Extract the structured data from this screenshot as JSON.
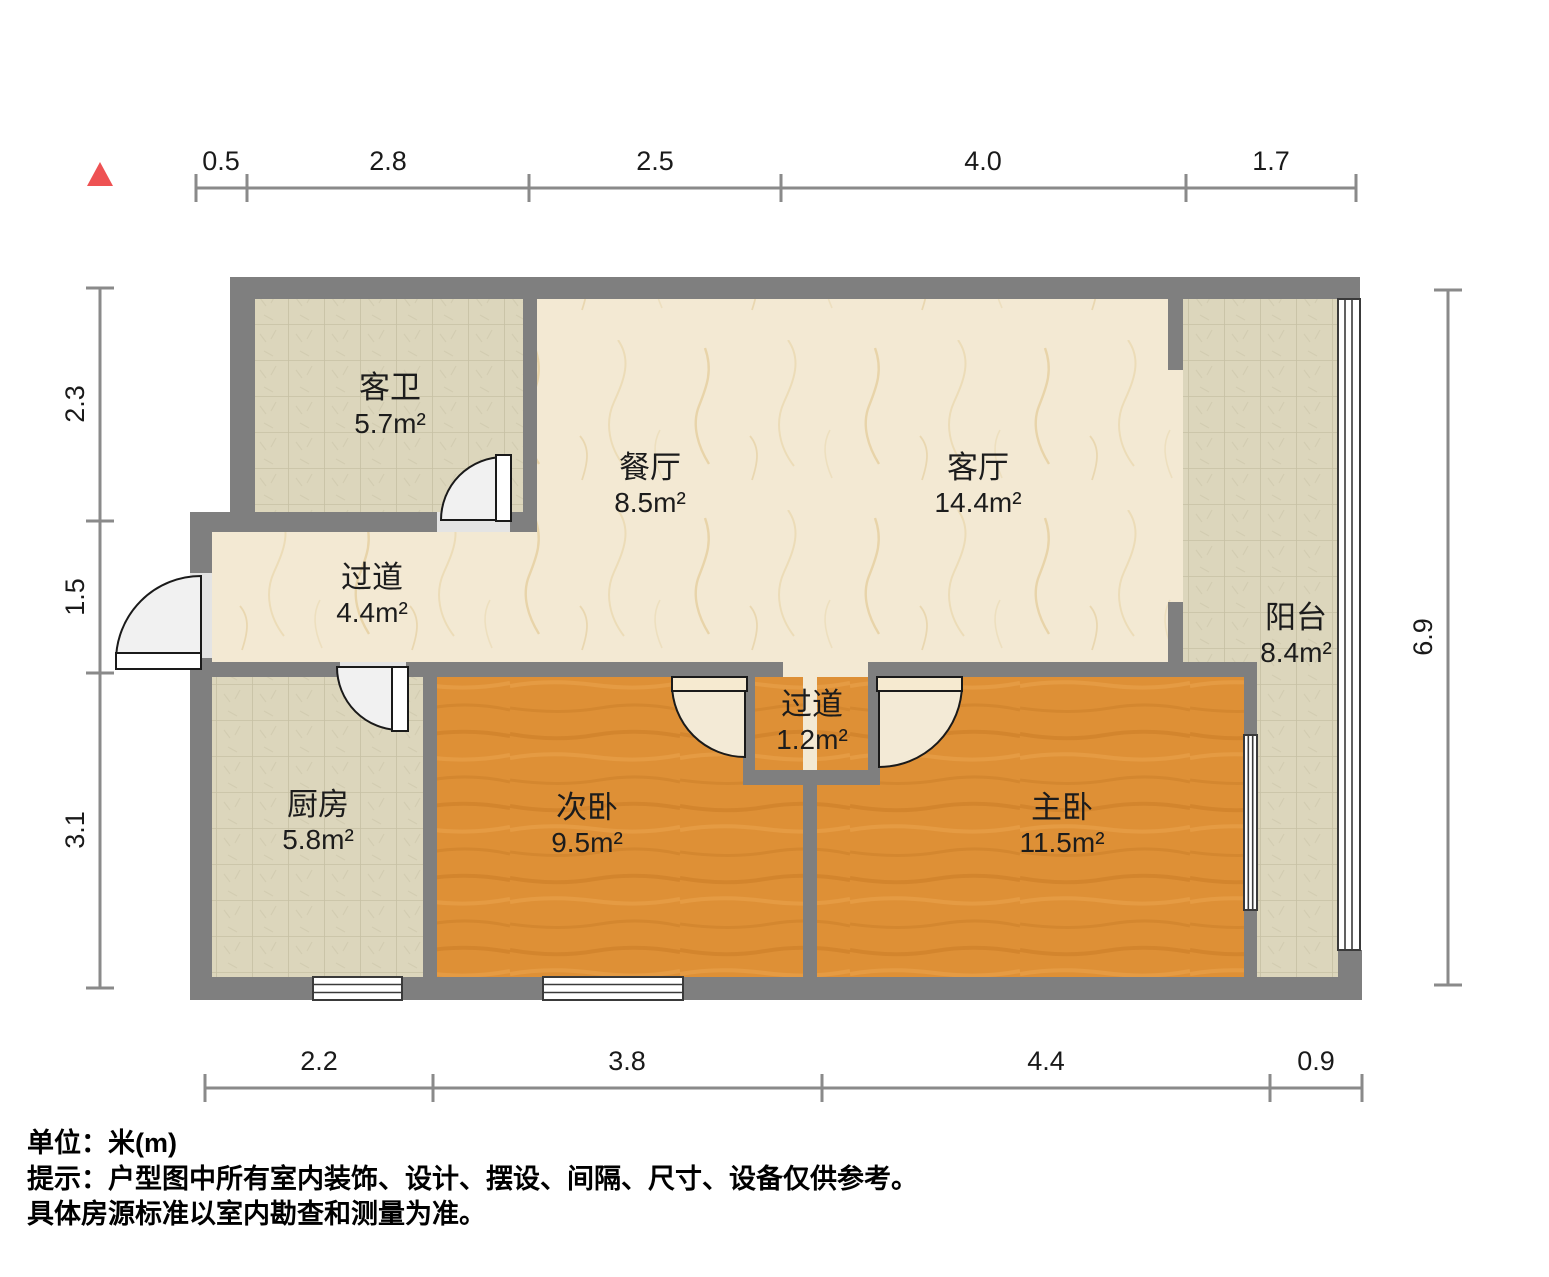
{
  "compass": {
    "color": "#ee5253"
  },
  "rooms": [
    {
      "id": "guest-bathroom",
      "name": "客卫",
      "area": "5.7m²"
    },
    {
      "id": "dining-room",
      "name": "餐厅",
      "area": "8.5m²"
    },
    {
      "id": "living-room",
      "name": "客厅",
      "area": "14.4m²"
    },
    {
      "id": "hallway",
      "name": "过道",
      "area": "4.4m²"
    },
    {
      "id": "balcony",
      "name": "阳台",
      "area": "8.4m²"
    },
    {
      "id": "kitchen",
      "name": "厨房",
      "area": "5.8m²"
    },
    {
      "id": "second-bedroom",
      "name": "次卧",
      "area": "9.5m²"
    },
    {
      "id": "inner-hallway",
      "name": "过道",
      "area": "1.2m²"
    },
    {
      "id": "master-bedroom",
      "name": "主卧",
      "area": "11.5m²"
    }
  ],
  "dims": {
    "top": [
      "0.5",
      "2.8",
      "2.5",
      "4.0",
      "1.7"
    ],
    "bottom": [
      "2.2",
      "3.8",
      "4.4",
      "0.9"
    ],
    "left": [
      "2.3",
      "1.5",
      "3.1"
    ],
    "right": [
      "6.9"
    ]
  },
  "notes": {
    "unit": "单位：米(m)",
    "tip1": "提示：户型图中所有室内装饰、设计、摆设、间隔、尺寸、设备仅供参考。",
    "tip2": "具体房源标准以室内勘查和测量为准。"
  },
  "colors": {
    "wall": "#7f7f7f",
    "marble_floor": "#f3e9d3",
    "tile_floor": "#dcd6bc",
    "wood_floor": "#de9036",
    "dimension_line": "#8a8a8a",
    "north_marker": "#ee5253"
  }
}
